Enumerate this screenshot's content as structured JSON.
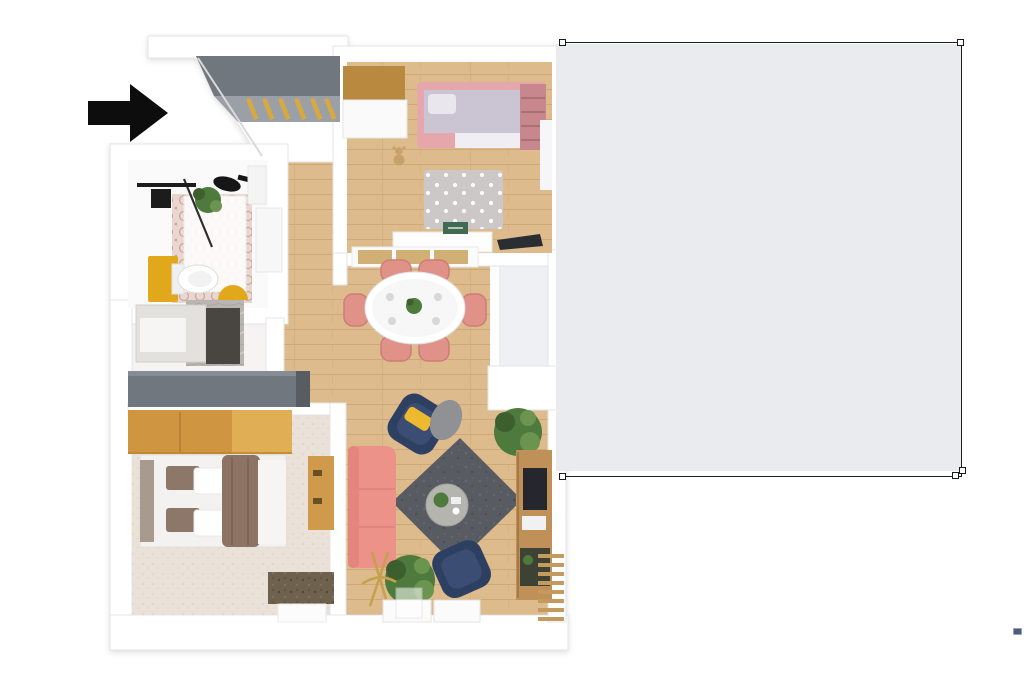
{
  "page": {
    "background": "#ffffff",
    "width": 1024,
    "height": 696
  },
  "annotation": {
    "selection_rect": {
      "x": 562,
      "y": 43,
      "width": 400,
      "height": 434,
      "fill": "#e9ebee",
      "stroke": "#1f1f1f",
      "handle_count": 5,
      "missing_left_border": true
    },
    "arrow": {
      "icon": "arrow-right-icon",
      "direction": "right",
      "color": "#0d0d0d"
    },
    "dash_marker": {
      "color": "#4e5d7c"
    }
  },
  "floor_plan": {
    "description": "Top-down 3D render of a small apartment",
    "rooms": [
      {
        "name": "entry-hall",
        "furniture": [
          "built-in wardrobe with slatted doors"
        ]
      },
      {
        "name": "kids-bedroom",
        "furniture": [
          "wardrobe",
          "pink bed",
          "pink wall shelf",
          "polka-dot rug",
          "teddy bear",
          "desk",
          "laptop"
        ]
      },
      {
        "name": "bathroom",
        "furniture": [
          "shower",
          "glass partition",
          "plant",
          "black sink",
          "yellow cabinet",
          "toilet",
          "yellow mat",
          "door"
        ]
      },
      {
        "name": "laundry-niche",
        "furniture": [
          "washing machine",
          "marble counter",
          "dark panel"
        ]
      },
      {
        "name": "hallway",
        "furniture": [
          "gray sideboard cabinet"
        ]
      },
      {
        "name": "dining-area",
        "furniture": [
          "white oval table",
          "six pink chairs",
          "sideboard with wood doors",
          "centerpiece plant"
        ]
      },
      {
        "name": "living-room",
        "furniture": [
          "pink sofa",
          "two navy armchairs",
          "yellow pillow",
          "dark gray rug",
          "round coffee table",
          "media console with TV",
          "plants",
          "gold floor lamp",
          "white consoles",
          "wood slat bench"
        ]
      },
      {
        "name": "bedroom",
        "furniture": [
          "wood wardrobe",
          "double bed with brown duvet",
          "bedside desk",
          "dark speckled rug",
          "white mat"
        ]
      },
      {
        "name": "balcony-door",
        "furniture": [
          "glass door"
        ]
      }
    ]
  },
  "colors": {
    "selection_fill": "#e9ebee",
    "selection_stroke": "#1f1f1f",
    "handle_fill": "#ffffff",
    "handle_stroke": "#1a1a1a",
    "arrow": "#0d0d0d",
    "dash_fill": "#4e5d7c",
    "dash_stroke": "#97a1b3",
    "wall": "#ffffff",
    "wall_stroke": "#e4e4e4",
    "wood_floor": "#ddbb8d",
    "wood_line": "#cfa878",
    "entry_wardrobe_dark": "#71777e",
    "entry_wardrobe_mid": "#9aa0a6",
    "entry_slat": "#d9a93f",
    "tile_base": "#e8d6cf",
    "tile_dot": "#c9a8a0",
    "carpet": "#eae1d8",
    "carpet_dot": "#d9cec2",
    "polka_rug": "#cbc8c7",
    "dark_rug": "#585c62",
    "dark_rug_light": "#686c72",
    "bed_rug": "#6e6250",
    "bed_rug_dark": "#53492f",
    "pink": "#e5a7ab",
    "pink_shelf": "#c8878d",
    "lilac": "#cbc5d3",
    "chair_pink": "#e09188",
    "chair_pink_dark": "#cd7d76",
    "sofa_pink": "#ec9289",
    "navy": "#2e3f62",
    "navy_light": "#3a4d73",
    "yellow": "#e2a81f",
    "pillow_yellow": "#edb92e",
    "wood_furniture": "#b9893f",
    "wardrobe_wood": "#d0953f",
    "wardrobe_wood_light": "#e0ae55",
    "media_wood": "#bf9059",
    "tv": "#25282d",
    "plant": "#4f7a3c",
    "plant_dark": "#3c5f2e",
    "plant_light": "#6b9450",
    "table_gray": "#b5b5af",
    "blanket_gray": "#8f9194",
    "brown": "#8d7363",
    "headboard": "#a89a8c",
    "marble": "#b9b5b1",
    "panel_dark": "#4a4440",
    "cabinet_cap": "#585d63",
    "cabinet_top": "#868c93",
    "laptop": "#2b2e33",
    "book_green": "#3f6b52",
    "gold": "#c5a14b",
    "white_furn": "#fbfbfb",
    "shower_black": "#1d1d1d"
  }
}
